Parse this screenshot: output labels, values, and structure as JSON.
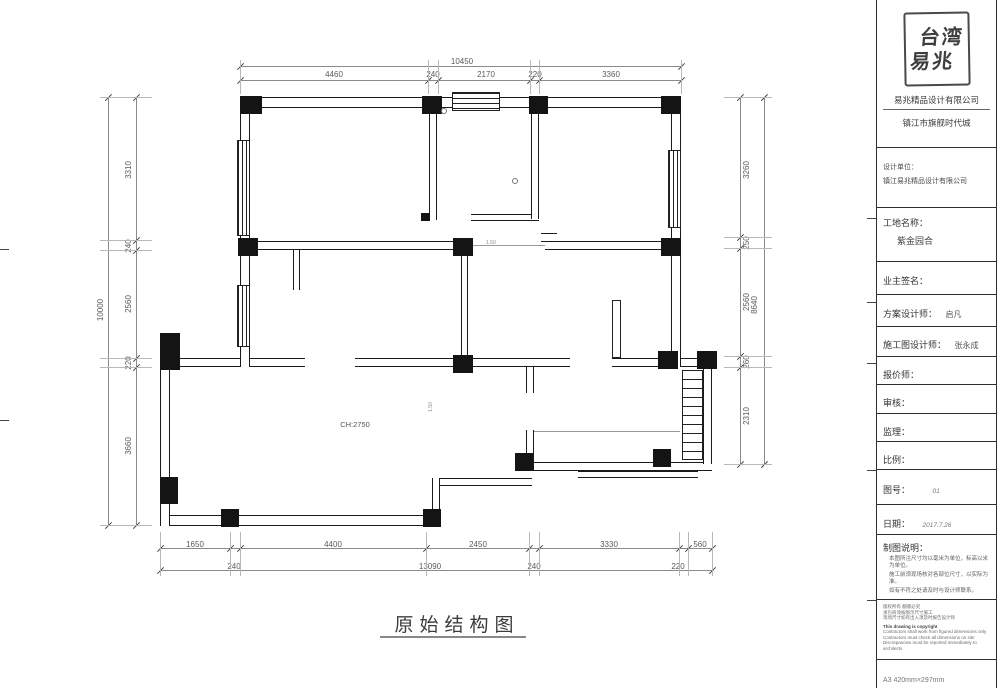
{
  "sidebar": {
    "stamp": {
      "line1": "台湾",
      "line2": "易兆"
    },
    "company_name": "易兆精品设计有限公司",
    "project_city": "镇江市旗舰时代城",
    "design_unit_label": "设计单位：",
    "design_unit_value": "镇江易兆精品设计有限公司",
    "site_name_label": "工地名称：",
    "site_name_value": "紫金园合",
    "owner_sign_label": "业主签名：",
    "scheme_designer_label": "方案设计师：",
    "scheme_designer_value": "启凡",
    "construction_designer_label": "施工图设计师：",
    "construction_designer_value": "张永成",
    "quoter_label": "报价师：",
    "audit_label": "审核：",
    "supervision_label": "监理：",
    "scale_label": "比例：",
    "figure_no_label": "图号：",
    "figure_no_value": "01",
    "date_label": "日期：",
    "date_value": "2017.7.26",
    "notes_title": "制图说明：",
    "notes": [
      "本图所注尺寸均以毫米为单位，标高以米为单位。",
      "施工前须现场核对各部位尺寸，以实际为准。",
      "如有不符之处请及时与设计师联系。"
    ],
    "copyright_cn": [
      "版权所有 翻版必究",
      "承包商须按图示尺寸施工",
      "现场尺寸如有出入须及时报告设计师"
    ],
    "copyright_en": [
      "This drawing is copyright",
      "Contractors shall work from figured dimensions only",
      "Contractors must check all dimensions on site",
      "Discrepancies must be reported immediately to architects"
    ],
    "paper_note": "A3 420mm×297mm"
  },
  "plan": {
    "title": "原始结构图",
    "ceiling_height": "CH:2750",
    "door_label_1": "1.50",
    "door_label_2": "1.50"
  },
  "dims": {
    "top_total": "10450",
    "top_chain": [
      "4460",
      "240",
      "2170",
      "220",
      "3360"
    ],
    "left_total": "10000",
    "left_chain": [
      "3310",
      "240",
      "2560",
      "220",
      "3660"
    ],
    "right_total": "8640",
    "right_chain": [
      "3260",
      "250",
      "2560",
      "260",
      "2310"
    ],
    "bottom_total": "13090",
    "bottom_chain": [
      "1650",
      "240",
      "4400",
      "2450",
      "240",
      "3330",
      "220",
      "560"
    ]
  }
}
